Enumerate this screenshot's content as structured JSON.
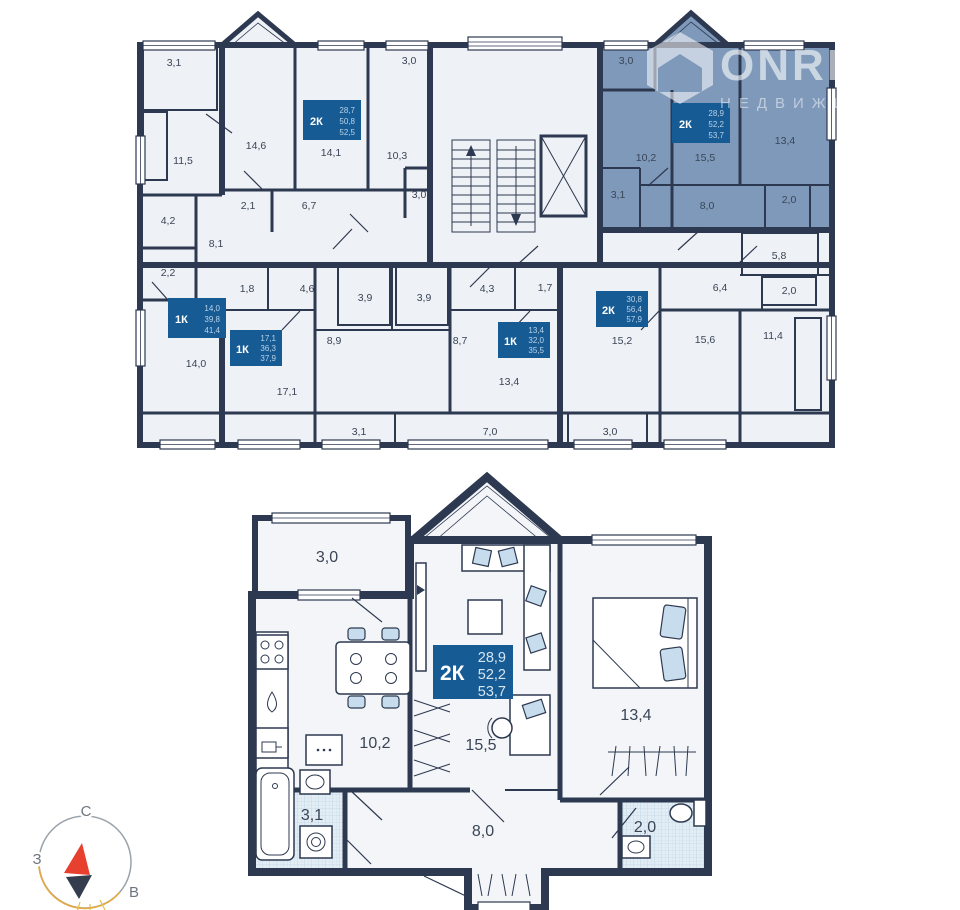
{
  "watermark": {
    "brand": "ONREALT",
    "subtitle": "НЕДВИЖИМОСТЬ"
  },
  "compass": {
    "north": "С",
    "west": "З",
    "east": "В"
  },
  "floor_plan": {
    "apartments": [
      {
        "id": "2k-left",
        "type": "2К",
        "area_rooms": "28,7",
        "area_living": "50,8",
        "area_total": "52,5",
        "selected": false,
        "rooms": [
          "3,1",
          "14,6",
          "14,1",
          "10,3",
          "3,0",
          "2,1",
          "6,7",
          "3,0"
        ]
      },
      {
        "id": "2k-selected",
        "type": "2К",
        "area_rooms": "28,9",
        "area_living": "52,2",
        "area_total": "53,7",
        "selected": true,
        "rooms": [
          "3,0",
          "10,2",
          "15,5",
          "13,4",
          "3,1",
          "8,0",
          "2,0"
        ]
      },
      {
        "id": "1k-a",
        "type": "1К",
        "area_rooms": "14,0",
        "area_living": "39,8",
        "area_total": "41,4",
        "selected": false,
        "rooms": [
          "11,5",
          "4,2",
          "2,2",
          "8,1",
          "14,0"
        ]
      },
      {
        "id": "1k-b",
        "type": "1К",
        "area_rooms": "17,1",
        "area_living": "36,3",
        "area_total": "37,9",
        "selected": false,
        "rooms": [
          "1,8",
          "4,6",
          "3,9",
          "8,9",
          "17,1",
          "3,1"
        ]
      },
      {
        "id": "1k-c",
        "type": "1К",
        "area_rooms": "13,4",
        "area_living": "32,0",
        "area_total": "35,5",
        "selected": false,
        "rooms": [
          "4,3",
          "1,7",
          "3,9",
          "8,7",
          "13,4",
          "7,0"
        ]
      },
      {
        "id": "2k-right",
        "type": "2К",
        "area_rooms": "30,8",
        "area_living": "56,4",
        "area_total": "57,9",
        "selected": false,
        "rooms": [
          "5,8",
          "6,4",
          "2,0",
          "15,2",
          "15,6",
          "11,4",
          "3,0"
        ]
      }
    ]
  },
  "detail_plan": {
    "unit": {
      "type": "2К",
      "area_rooms": "28,9",
      "area_living": "52,2",
      "area_total": "53,7"
    },
    "rooms": {
      "balcony": "3,0",
      "kitchen": "10,2",
      "living": "15,5",
      "bedroom": "13,4",
      "bathroom": "3,1",
      "hall": "8,0",
      "wc": "2,0"
    }
  },
  "colors": {
    "selected_fill": "#7e99ba",
    "wall": "#2d3950",
    "card_bg": "#175b94",
    "compass_red": "#e8402f"
  }
}
